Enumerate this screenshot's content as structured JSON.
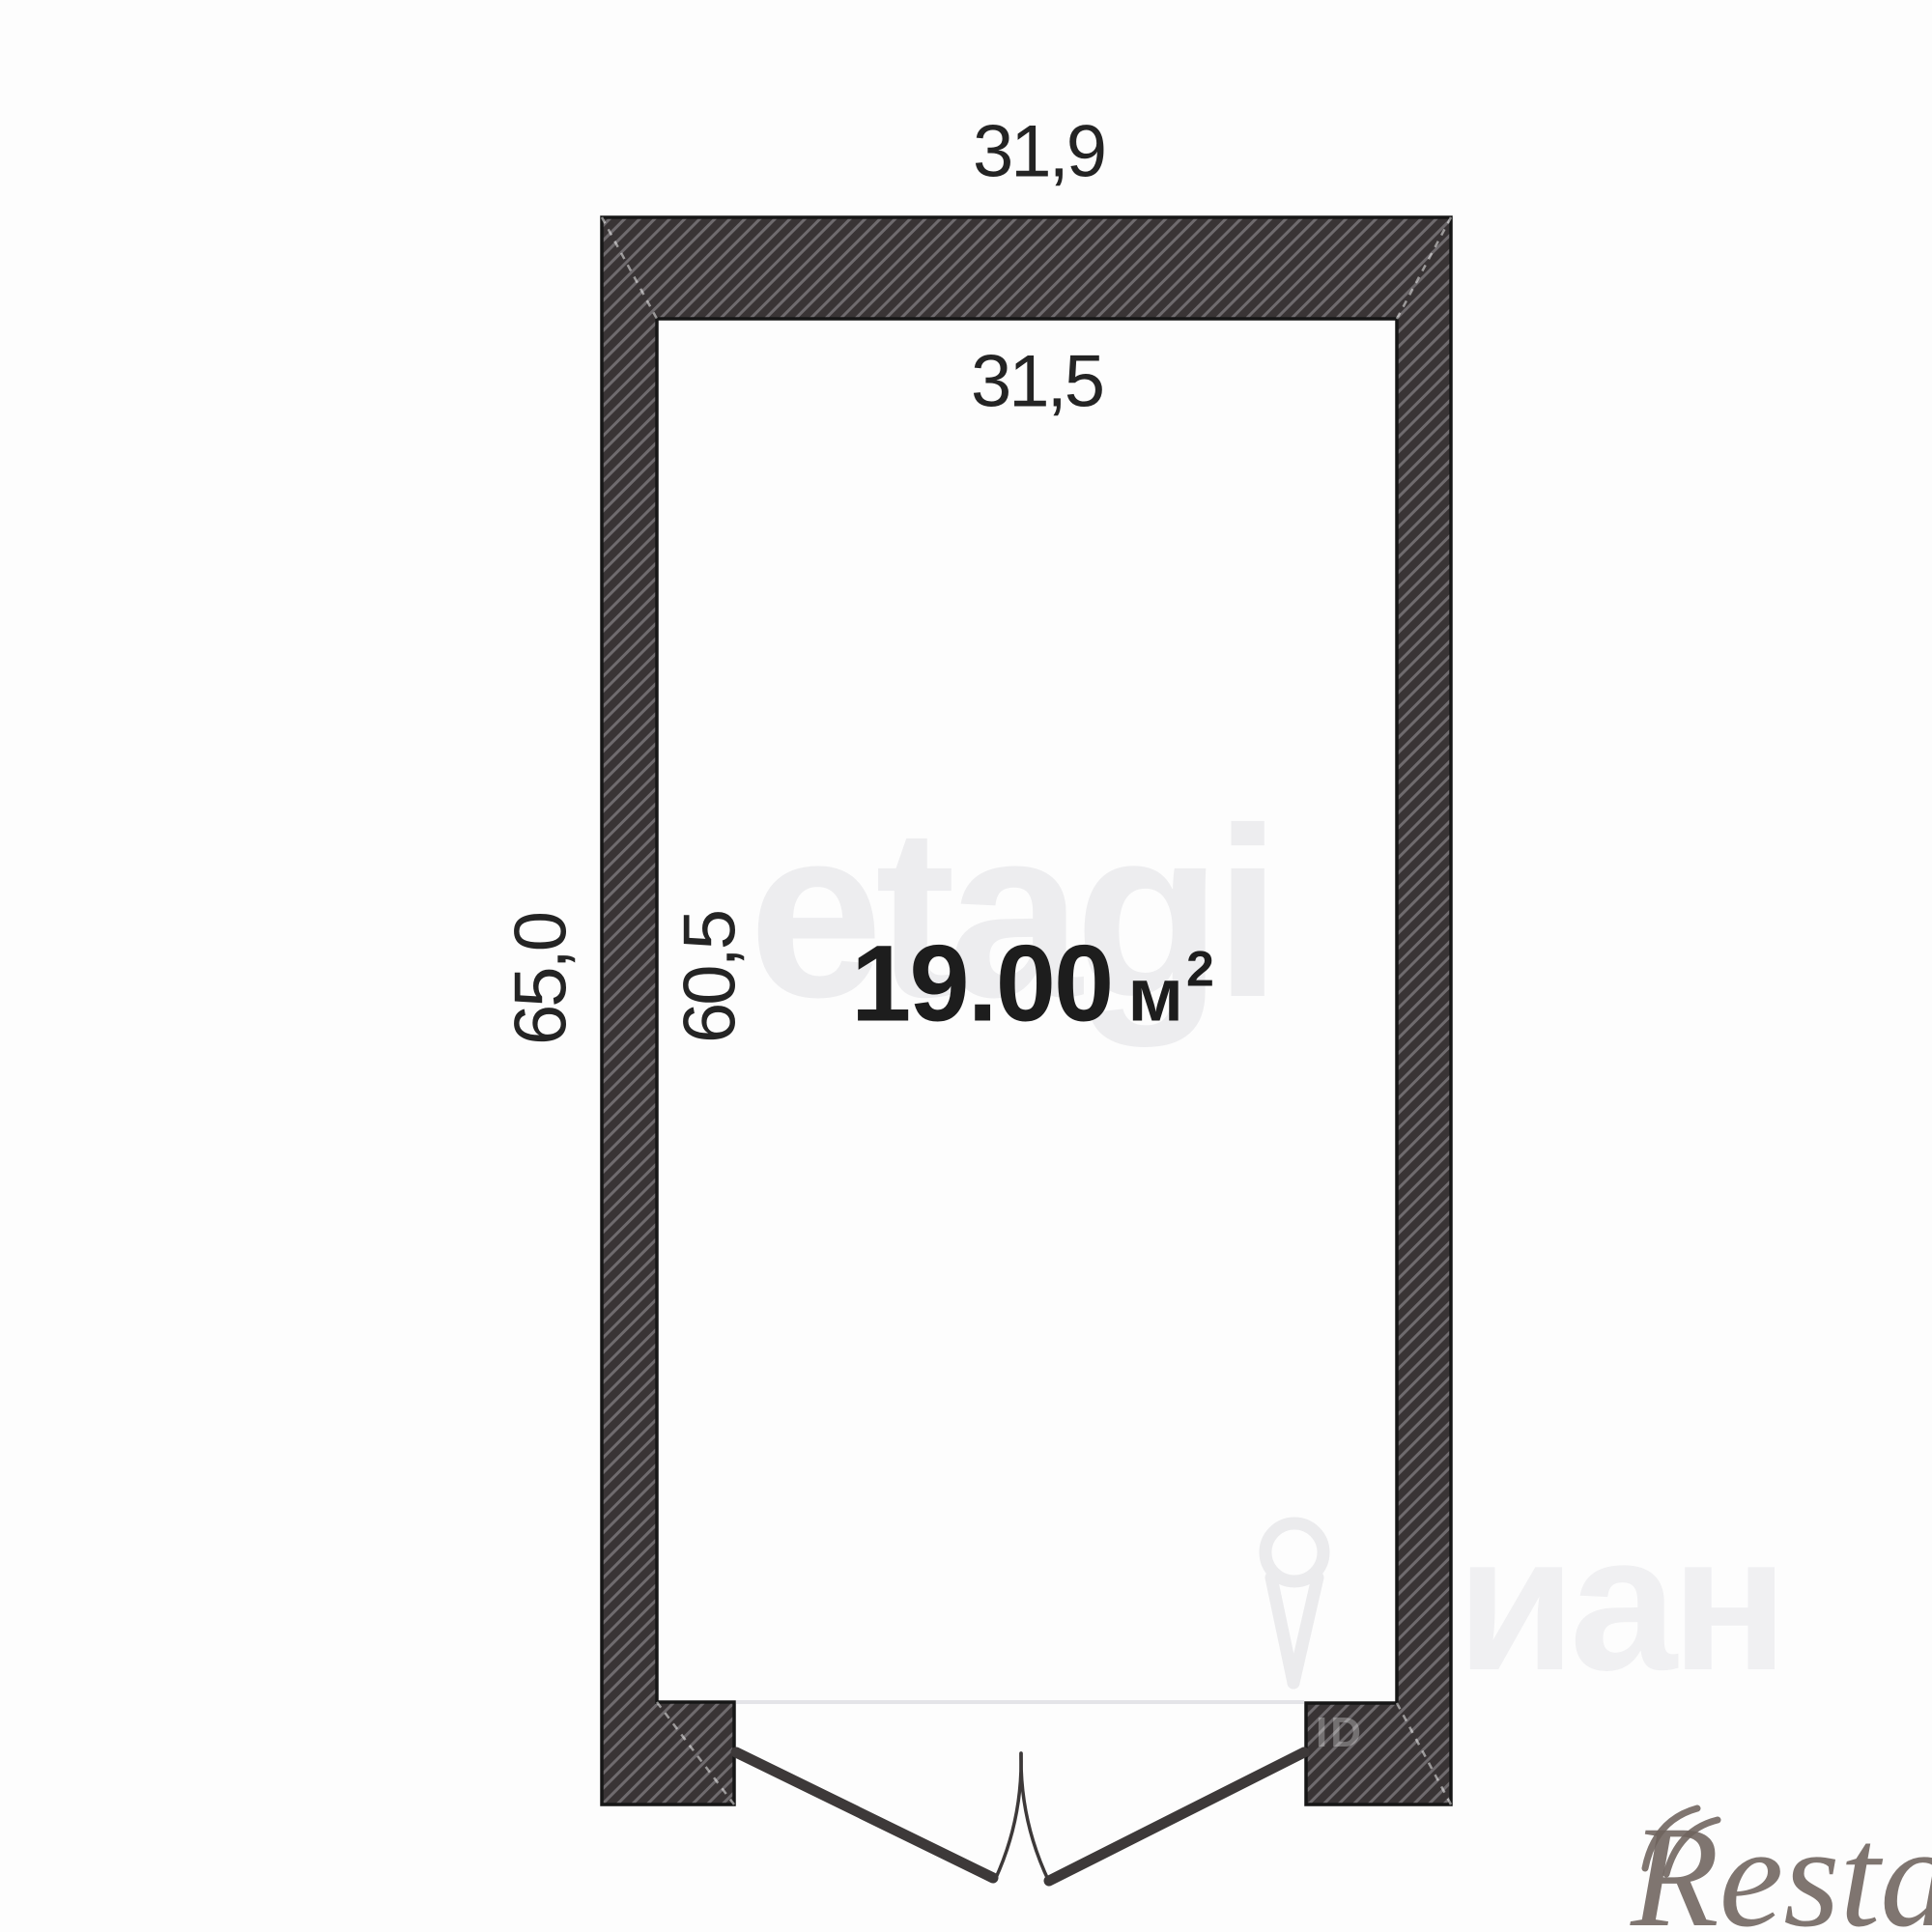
{
  "plan": {
    "type": "floor-plan",
    "area": {
      "value": "19.00",
      "unit": "м",
      "sup": "2"
    },
    "dimensions": {
      "top_outer": "31,9",
      "top_inner": "31,5",
      "left_outer": "65,0",
      "left_inner": "60,5"
    },
    "colors": {
      "wall_fill": "#393435",
      "wall_hatch_stripe": "#6f6b6e",
      "wall_outline": "#161616",
      "dimension_text": "#242424",
      "area_text": "#1d1d1d",
      "door_stroke": "#3d3939",
      "threshold_line": "#e4e4e8",
      "watermark_light": "#ededef",
      "watermark_restate": "#6e635d"
    }
  },
  "watermarks": {
    "etagi": "etagi",
    "cian_letters": "иан",
    "cian_id": "ID",
    "restate": "Restate"
  }
}
